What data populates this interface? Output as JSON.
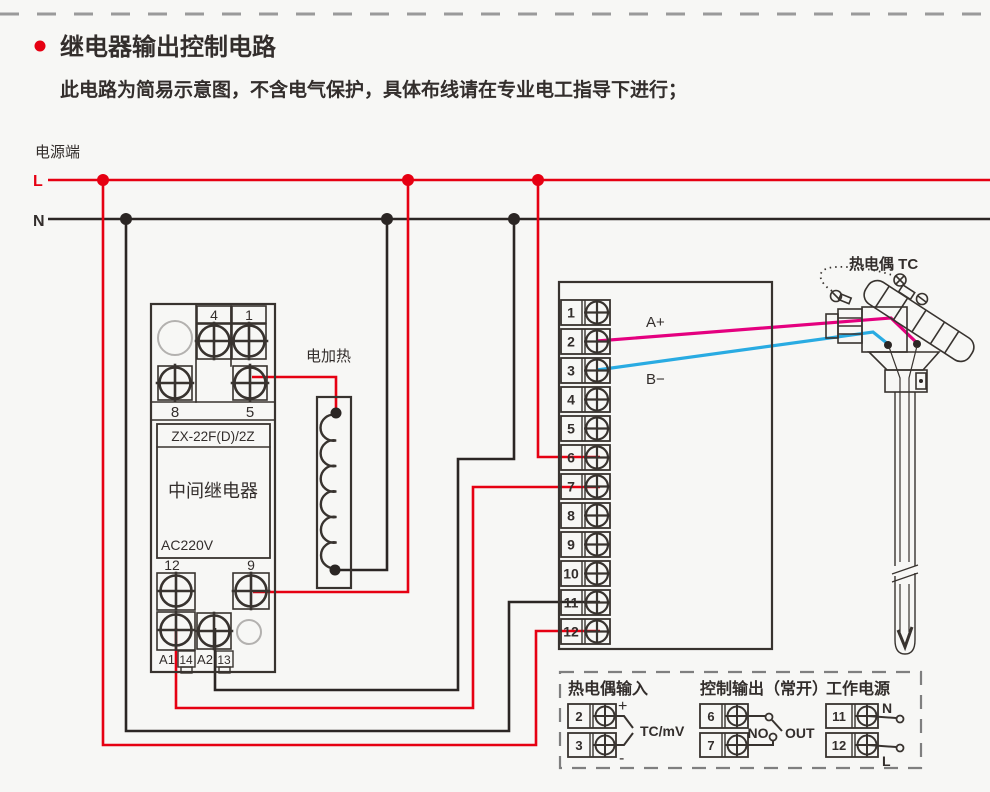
{
  "page": {
    "title": "继电器输出控制电路",
    "subtitle": "此电路为简易示意图，不含电气保护，具体布线请在专业电工指导下进行；"
  },
  "power": {
    "label": "电源端",
    "live_label": "L",
    "neutral_label": "N",
    "live_color": "#e60012",
    "neutral_color": "#2b2624"
  },
  "relay": {
    "model": "ZX-22F(D)/2Z",
    "name": "中间继电器",
    "voltage": "AC220V",
    "terminal_4": "4",
    "terminal_1": "1",
    "terminal_8": "8",
    "terminal_5": "5",
    "terminal_12": "12",
    "terminal_9": "9",
    "terminal_a1": "A1",
    "terminal_14": "14",
    "terminal_a2": "A2",
    "terminal_13": "13"
  },
  "heater": {
    "label": "电加热"
  },
  "instrument": {
    "terminals": [
      "1",
      "2",
      "3",
      "4",
      "5",
      "6",
      "7",
      "8",
      "9",
      "10",
      "11",
      "12"
    ],
    "tc_plus_label": "A+",
    "tc_minus_label": "B−",
    "tc_plus_color": "#e4007f",
    "tc_minus_color": "#29abe2"
  },
  "thermocouple": {
    "label": "热电偶 TC"
  },
  "legend": {
    "tc_input": {
      "title": "热电偶输入",
      "terminal_top": "2",
      "terminal_bottom": "3",
      "plus": "+",
      "minus": "-",
      "signal": "TC/mV"
    },
    "control_output": {
      "title": "控制输出（常开）",
      "terminal_top": "6",
      "terminal_bottom": "7",
      "no_label": "NO",
      "out_label": "OUT"
    },
    "working_power": {
      "title": "工作电源",
      "terminal_top": "11",
      "terminal_bottom": "12",
      "n_label": "N",
      "l_label": "L"
    }
  }
}
